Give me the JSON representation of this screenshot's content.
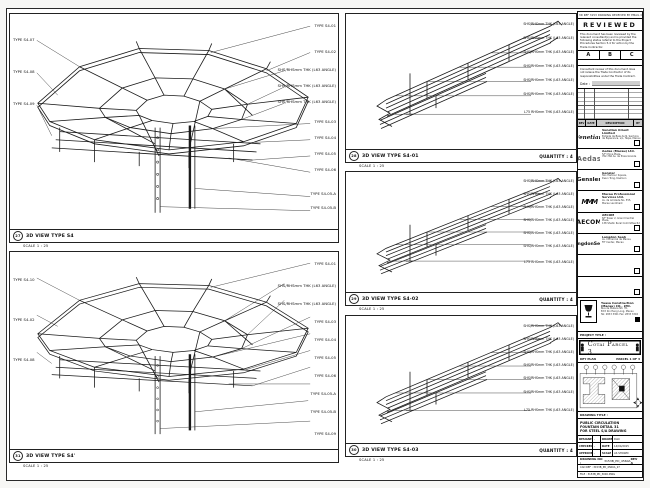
{
  "sheet": {
    "top_note": "3D REF 3153 DRAWING RECEIVED BY EMAIL ON 14 APR 2015"
  },
  "viewports": [
    {
      "bubble": "27",
      "title": "3D VIEW TYPE S4",
      "scale": "SCALE 1 : 25",
      "labels_left": [
        "TYPE S4-07",
        "TYPE S4-08",
        "TYPE S4-09"
      ],
      "labels_right": [
        "TYPE S4-01",
        "TYPE S4-02",
        "SHS/RHSmm THK (L63 ANGLE)",
        "SHS/RHSmm THK (L63 ANGLE)",
        "SHS/RHSmm THK (L63 ANGLE)",
        "TYPE S4-03",
        "TYPE S4-04",
        "TYPE S4-05",
        "TYPE S4-06",
        "TYPE S4-05-A",
        "TYPE S4-05-B"
      ]
    },
    {
      "bubble": "31",
      "title": "3D VIEW TYPE S4'",
      "scale": "SCALE 1 : 25",
      "labels_left": [
        "TYPE S4-10",
        "TYPE S4-02",
        "TYPE S4-08"
      ],
      "labels_right": [
        "TYPE S4-01",
        "SHS/RHSmm THK (L63 ANGLE)",
        "SHS/RHSmm THK (L63 ANGLE)",
        "TYPE S4-03",
        "TYPE S4-04",
        "TYPE S4-05",
        "TYPE S4-06",
        "TYPE S4-05-A",
        "TYPE S4-05-B",
        "TYPE S4-09"
      ]
    },
    {
      "bubble": "28",
      "title": "3D VIEW TYPE S4-01",
      "quantity": "QUANTITY : 4",
      "scale": "SCALE 1 : 25",
      "labels_right": [
        "SHS/RHSmm THK (L63 ANGLE)",
        "SHS/RHSmm THK (L63 ANGLE)",
        "SHS/RHSmm THK (L63 ANGLE)",
        "SHS/RHSmm THK (L63 ANGLE)",
        "SHS/RHSmm THK (L63 ANGLE)",
        "SHS/RHSmm THK (L63 ANGLE)",
        "L75 RHSmm THK (L63 ANGLE)"
      ]
    },
    {
      "bubble": "29",
      "title": "3D VIEW TYPE S4-02",
      "quantity": "QUANTITY : 4",
      "scale": "SCALE 1 : 25",
      "labels_right": [
        "SHS/RHSmm THK (L63 ANGLE)",
        "SHS/RHSmm THK (L63 ANGLE)",
        "SHS/RHSmm THK (L63 ANGLE)",
        "SHS/RHSmm THK (L63 ANGLE)",
        "SHS/RHSmm THK (L63 ANGLE)",
        "SHS/RHSmm THK (L63 ANGLE)",
        "L75 RHSmm THK (L63 ANGLE)"
      ]
    },
    {
      "bubble": "30",
      "title": "3D VIEW TYPE S4-03",
      "quantity": "QUANTITY : 4",
      "scale": "SCALE 1 : 25",
      "labels_right": [
        "SHS/RHSmm THK (L63 ANGLE)",
        "SHS/RHSmm THK (L63 ANGLE)",
        "SHS/RHSmm THK (L63 ANGLE)",
        "SHS/RHSmm THK (L63 ANGLE)",
        "SHS/RHSmm THK (L63 ANGLE)",
        "SHS/RHSmm THK (L63 ANGLE)",
        "L75 RHSmm THK (L63 ANGLE)"
      ]
    }
  ],
  "stamp": {
    "title": "REVIEWED",
    "para1": "This document has been reviewed by the relevant consultant(s) and is provided the following status referral to the Project Procedures Section 5.4 for action by the Trade Contractor.",
    "boxes": [
      "A",
      "B",
      "C"
    ],
    "para2": "Consultant review of this document does not relieve the Trade Contractor of its responsibilities under the Trade Contract.",
    "date_label": "Date :"
  },
  "revisions": {
    "headers": [
      "REV",
      "DATE",
      "DESCRIPTION",
      "BY"
    ]
  },
  "consultants": [
    {
      "logo": "Venetian",
      "name": "Venetian Orient Limited",
      "line1": "Estrada da Baia de N. Senhora",
      "line2": "da Esperanca, s/n, Taipa, Macau"
    },
    {
      "logo": "Aedas",
      "name": "Aedas (Macau) Ltd.",
      "line1": "5/F China Plaza,",
      "line2": "762-766 Av. da Praia Grande"
    },
    {
      "logo": "Gensler",
      "name": "Gensler",
      "line1": "Two Harbour Square,",
      "line2": "Kwun Tong, Kowloon"
    },
    {
      "logo": "MMM",
      "name": "Macau Professional Services Ltd.",
      "line1": "Av. da Amizade No. 555,",
      "line2": "Macau Landmark"
    },
    {
      "logo": "AECOM",
      "name": "AECOM",
      "line1": "8/F Tower 2, Grand Central Plaza,",
      "line2": "138 Shatin Rural Committee Rd"
    },
    {
      "logo": "LangdonSeah",
      "name": "Langdon Seah",
      "line1": "Av. Comercial de Macau,",
      "line2": "FIT Center, Macau"
    }
  ],
  "contractor": {
    "name": "Yuasa Construction (Macau) CO., LTD.",
    "line1": "Rua de Malaca No. 35,",
    "line2": "Edif. Kin Heng Long, Macau",
    "line3": "Tel: 2833 3301  Fax: 2833 3302"
  },
  "project": {
    "label": "PROJECT TITLE :",
    "name": "Cotai Parcel 3"
  },
  "keyplan": {
    "label": "KEY PLAN",
    "note": "PARCEL 1 OF 3"
  },
  "drawing": {
    "label": "DRAWING TITLE :",
    "line1": "PUBLIC CIRCULATION",
    "line2": "FOUNTAIN DETAIL 31",
    "line3": "FOR STEEL S/A DRAWING"
  },
  "info": {
    "rows": [
      [
        "DESIGNED",
        "-",
        "DRAWN",
        "DAO"
      ],
      [
        "CHECKED",
        "-",
        "DATE",
        "14/04/2015"
      ],
      [
        "APPROVED",
        "-",
        "SCALE",
        "AS SHOWN"
      ]
    ]
  },
  "numbers": {
    "drawing_no_label": "DRAWING NO :",
    "drawing_no": "3153B_PD_4560A",
    "rev": "REV A",
    "cad_ref": "CAD REF : 3153B_PD_4560A_27",
    "file_ref": "FILE : 3153B_PD_3000.DWG"
  }
}
